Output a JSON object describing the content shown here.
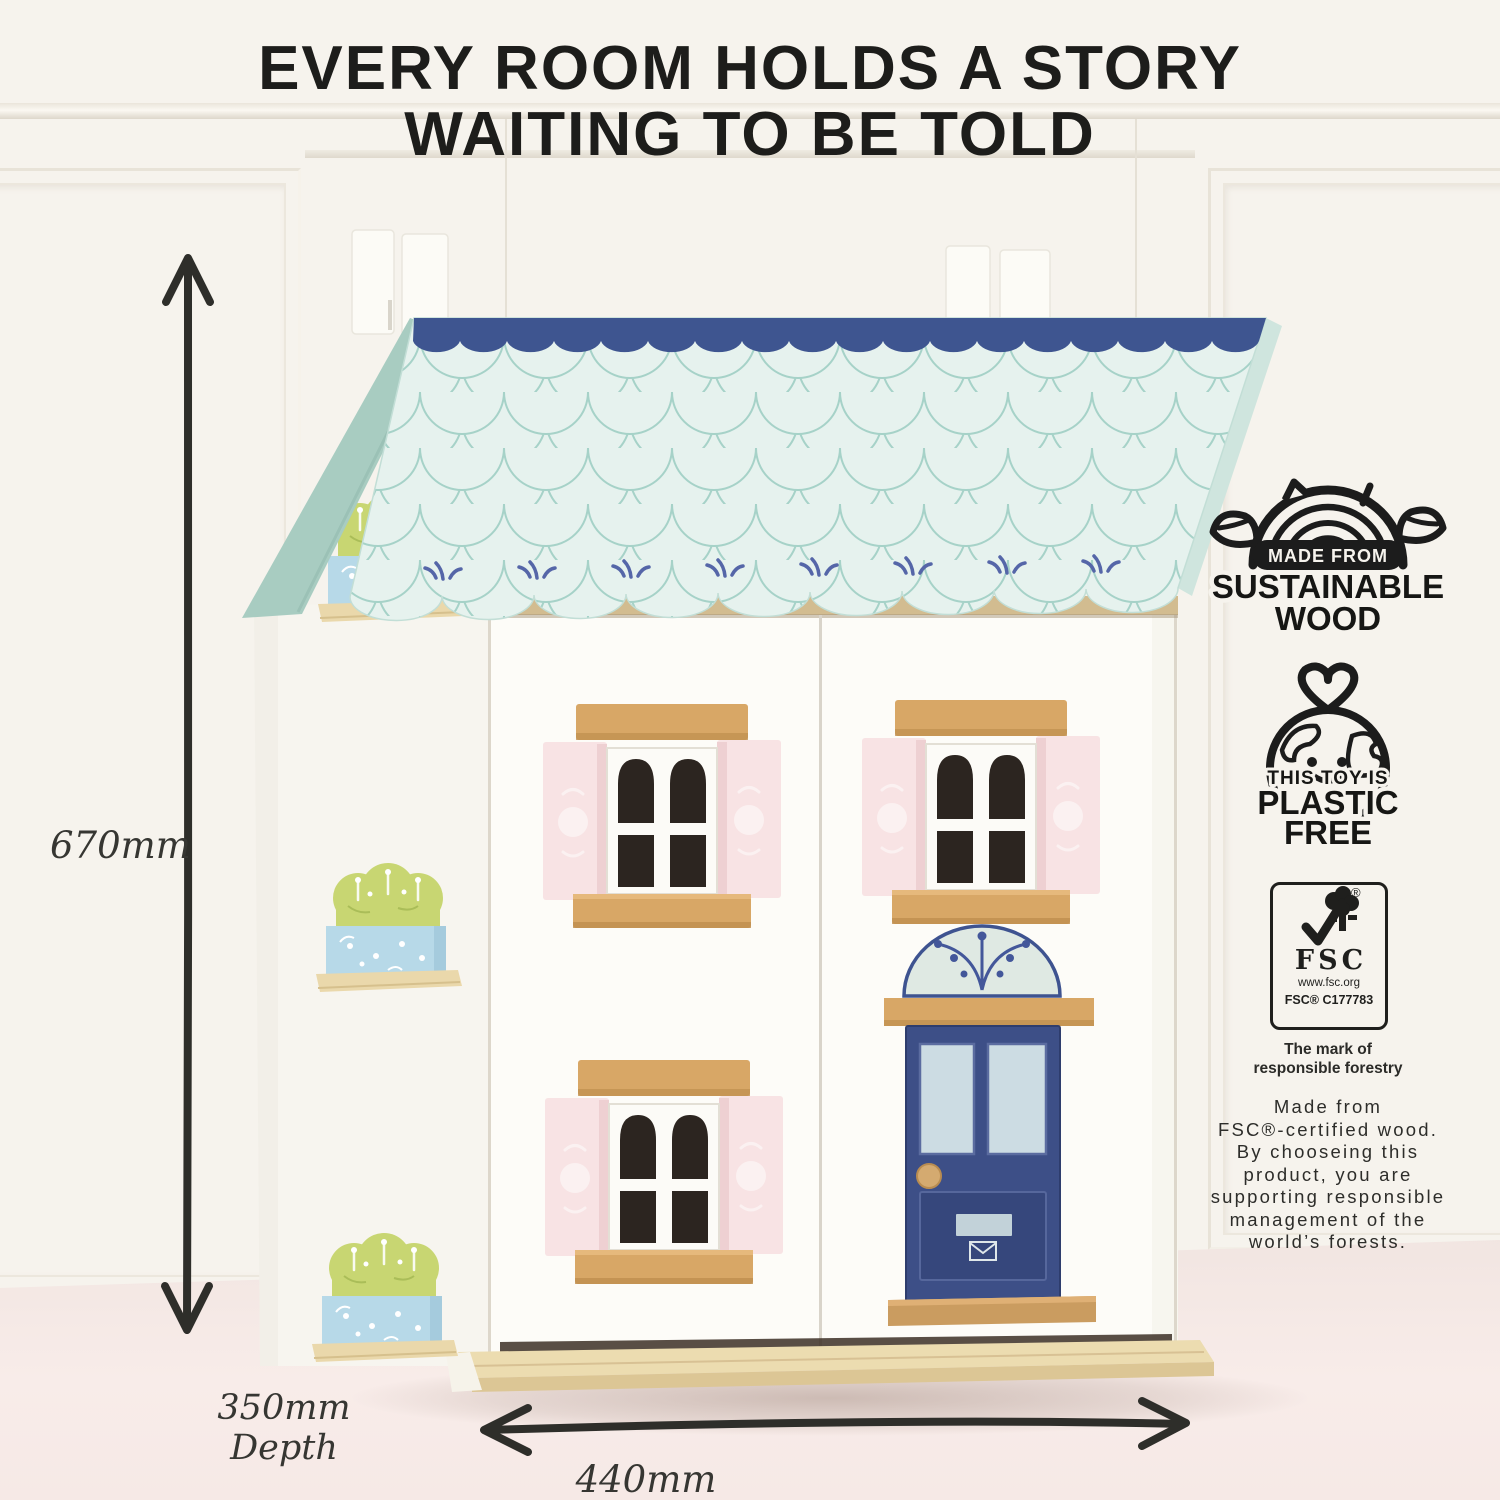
{
  "title": {
    "line1": "EVERY ROOM HOLDS A STORY",
    "line2": "WAITING TO BE TOLD"
  },
  "dimensions": {
    "height": "670mm",
    "depth_value": "350mm",
    "depth_word": "Depth",
    "width": "440mm"
  },
  "badges": {
    "sustainable_wood": {
      "icon": "log-with-leaves-icon",
      "made_from": "MADE FROM",
      "sustainable": "SUSTAINABLE",
      "wood": "WOOD"
    },
    "plastic_free": {
      "icon": "heart-earth-icon",
      "this_toy_is": "THIS TOY IS",
      "plastic": "PLASTIC",
      "free": "FREE"
    },
    "fsc": {
      "icon": "fsc-tree-checkmark-icon",
      "acronym": "FSC",
      "registered": "®",
      "url": "www.fsc.org",
      "license": "FSC® C177783",
      "tagline_line1": "The mark of",
      "tagline_line2": "responsible forestry"
    }
  },
  "description": {
    "lines": [
      "Made from",
      "FSC®-certified wood.",
      "By chooseing this",
      "product, you are",
      "supporting responsible",
      "management of the",
      "world’s forests."
    ]
  },
  "colors": {
    "background_wall": "#f6f3ed",
    "floor_pink": "#f5e9e5",
    "ink": "#1d1d1b",
    "roof_mint": "#e6f2ee",
    "roof_scale_line": "#a6d2c8",
    "ridge_navy": "#3e5590",
    "gable_mint": "#a8ccc1",
    "wall_white": "#fdfcf8",
    "wood": "#d8a766",
    "base_plywood": "#ead8ab",
    "shutter_pink": "#f8e3e4",
    "window_pane_dark": "#2c2520",
    "door_navy": "#3d4f87",
    "door_pane_blue": "#ccdce3",
    "plant_green": "#c8d672",
    "flower_box_blue": "#b7d9e8"
  }
}
